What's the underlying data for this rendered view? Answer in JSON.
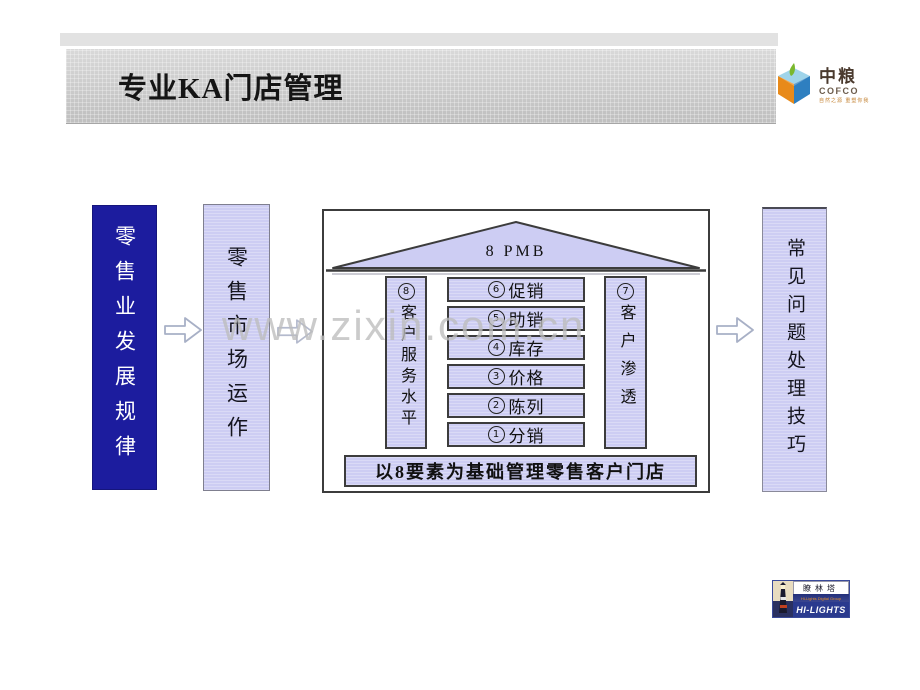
{
  "title_bar": {
    "title": "专业KA门店管理"
  },
  "cofco_logo": {
    "name_cn": "中粮",
    "name_en": "COFCO",
    "tagline": "自然之源 重塑你我"
  },
  "flow": {
    "box1_label": "零售业发展规律",
    "box2_label": "零售市场运作",
    "box3_label": "常见问题处理技巧"
  },
  "diagram": {
    "roof_label": "8 PMB",
    "left_pillar": {
      "num": "8",
      "label": "客户服务水平"
    },
    "right_pillar": {
      "num": "7",
      "label": "客户渗透"
    },
    "stack": [
      {
        "num": "6",
        "label": "促销"
      },
      {
        "num": "5",
        "label": "助销"
      },
      {
        "num": "4",
        "label": "库存"
      },
      {
        "num": "3",
        "label": "价格"
      },
      {
        "num": "2",
        "label": "陈列"
      },
      {
        "num": "1",
        "label": "分销"
      }
    ],
    "base_label": "以8要素为基础管理零售客户门店"
  },
  "watermark": "www.zixin.com.cn",
  "hilights_logo": {
    "name_cn": "瞭林塔",
    "subtitle": "Hi-Lights Digital Group",
    "name_en": "HI-LIGHTS"
  },
  "colors": {
    "dark_blue": "#1c1c9e",
    "lavender": "#cdcdf3",
    "band_gray": "#c9c9c9",
    "diagram_border": "#3c3c3c"
  }
}
